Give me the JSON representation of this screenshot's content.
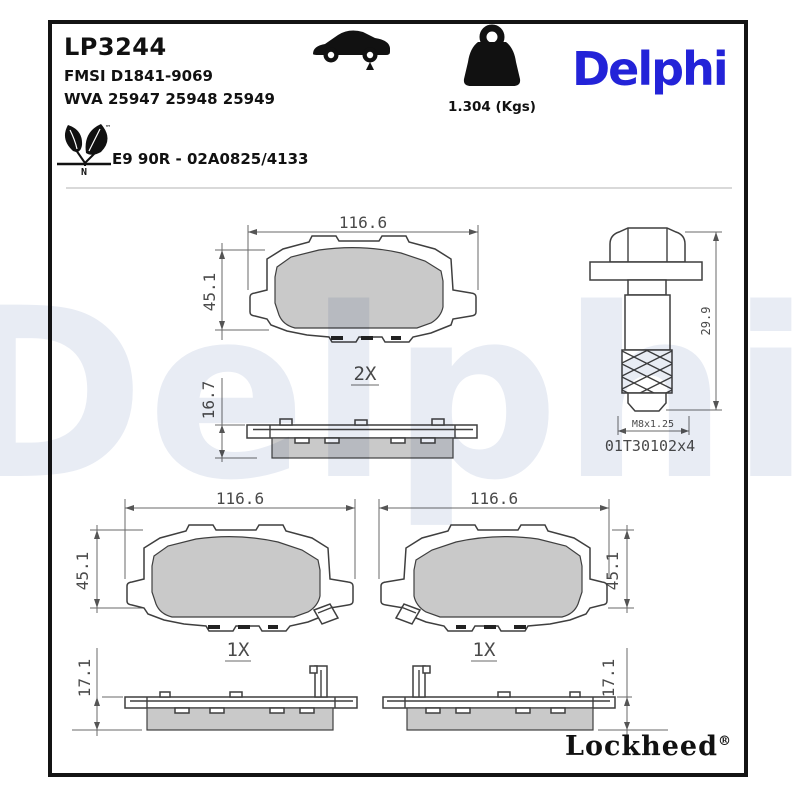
{
  "header": {
    "part_number": "LP3244",
    "fmsi": "FMSI D1841-9069",
    "wva": "WVA 25947 25948 25949",
    "weight": "1.304 (Kgs)",
    "brand": "Delphi",
    "approval": "E9 90R - 02A0825/4133",
    "eco_letter": "N",
    "eco_tm": "™"
  },
  "drawings": {
    "pad_front_top": {
      "width_dim": "116.6",
      "height_dim": "45.1",
      "qty": "2X"
    },
    "pad_side_top": {
      "thickness_dim": "16.7"
    },
    "bolt": {
      "length_dim": "29.9",
      "thread_dim": "M8x1.25",
      "part_ref": "01T30102x4"
    },
    "pad_front_left": {
      "width_dim": "116.6",
      "height_dim": "45.1",
      "qty": "1X"
    },
    "pad_front_right": {
      "width_dim": "116.6",
      "height_dim": "45.1",
      "qty": "1X"
    },
    "pad_side_left": {
      "thickness_dim": "17.1"
    },
    "pad_side_right": {
      "thickness_dim": "17.1"
    }
  },
  "footer": {
    "brand": "Lockheed",
    "registered": "®"
  },
  "watermark": "Delphi",
  "colors": {
    "brand_blue": "#2323d8",
    "friction_gray": "#c9c9c9",
    "line_dark": "#3f3f3f",
    "dimension_text": "#4a4a4a",
    "watermark_tint": "#e8ecf4"
  }
}
